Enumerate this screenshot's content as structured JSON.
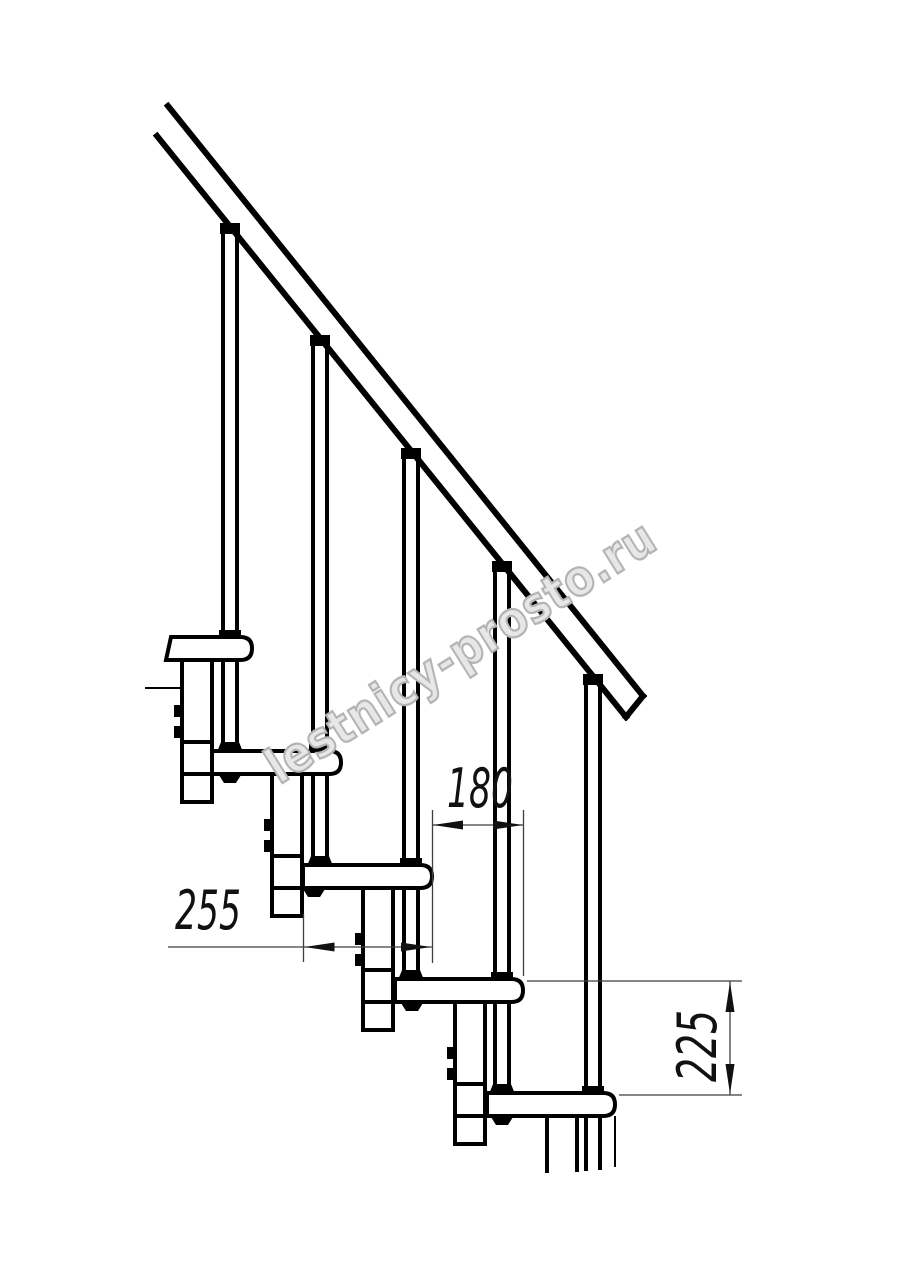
{
  "colors": {
    "line": "#000000",
    "dimension_line": "#3f3f3f",
    "dimension_text": "#111111",
    "watermark_outline": "#b4b4b4",
    "background": "#ffffff"
  },
  "drawing": {
    "description": "modular staircase side elevation",
    "dimensions": {
      "going": {
        "label": "180"
      },
      "tread_depth": {
        "label": "255"
      },
      "rise": {
        "label": "225"
      }
    },
    "watermark": {
      "text": "lestnicy-prosto.ru"
    }
  }
}
